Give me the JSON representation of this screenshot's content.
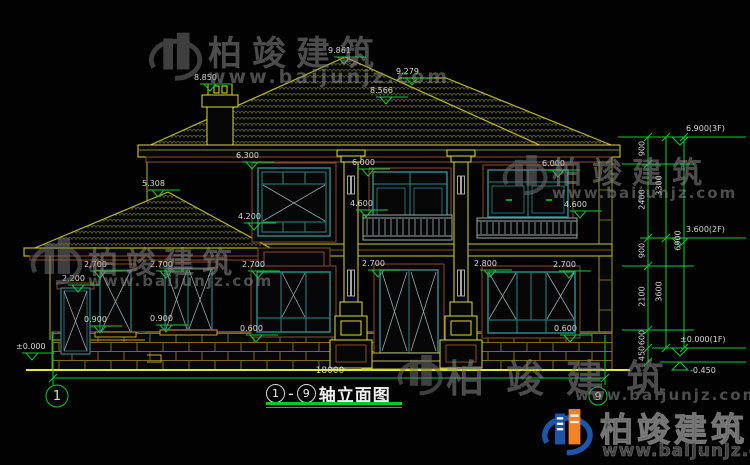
{
  "brand": {
    "name": "柏竣建筑",
    "url": "www.baijunjz.com"
  },
  "title": {
    "axis_start": "1",
    "axis_end": "9",
    "dash": "—",
    "name": "轴立面图"
  },
  "axis_bubbles": {
    "left": "1",
    "right": "9"
  },
  "overall_dim": "18000",
  "marks": {
    "peak": "9.861",
    "ridge": "9.279",
    "valley": "8.566",
    "chimney": "8.850",
    "annex_roof": "5.308",
    "f2_win_left_top": "6.300",
    "f2_door_top": "6.000",
    "f2_win_right_top": "6.000",
    "f2_rail_left": "4.600",
    "f2_rail_right": "4.600",
    "f2_win_sill": "4.200",
    "f1_annex_door": "2.200",
    "f1_win_a": "2.700",
    "f1_win_b": "2.700",
    "f1_win_c": "2.700",
    "f1_door": "2.700",
    "f1_win_d": "2.800",
    "f1_win_e": "2.700",
    "f1_sill_a": "0.900",
    "f1_sill_b": "0.900",
    "f1_sill_c": "0.600",
    "f1_sill_d": "0.600",
    "ground": "±0.000"
  },
  "right_dims": {
    "level_3f": "6.900(3F)",
    "level_2f": "3.600(2F)",
    "level_1f": "±0.000(1F)",
    "level_base": "-0.450",
    "seg_a": "900",
    "seg_b": "2400",
    "seg_c": "900",
    "seg_d": "2100",
    "seg_e": "600",
    "seg_f": "450",
    "sub_a": "3300",
    "sub_b": "3600",
    "total": "6900"
  },
  "colors": {
    "dimension_green": "#00cc33",
    "line_yellow": "#c8c832",
    "frame_teal": "#2e8585",
    "trim_brown": "#8a4a28",
    "logo_blue": "#1d55a8",
    "logo_orange": "#f08326"
  }
}
